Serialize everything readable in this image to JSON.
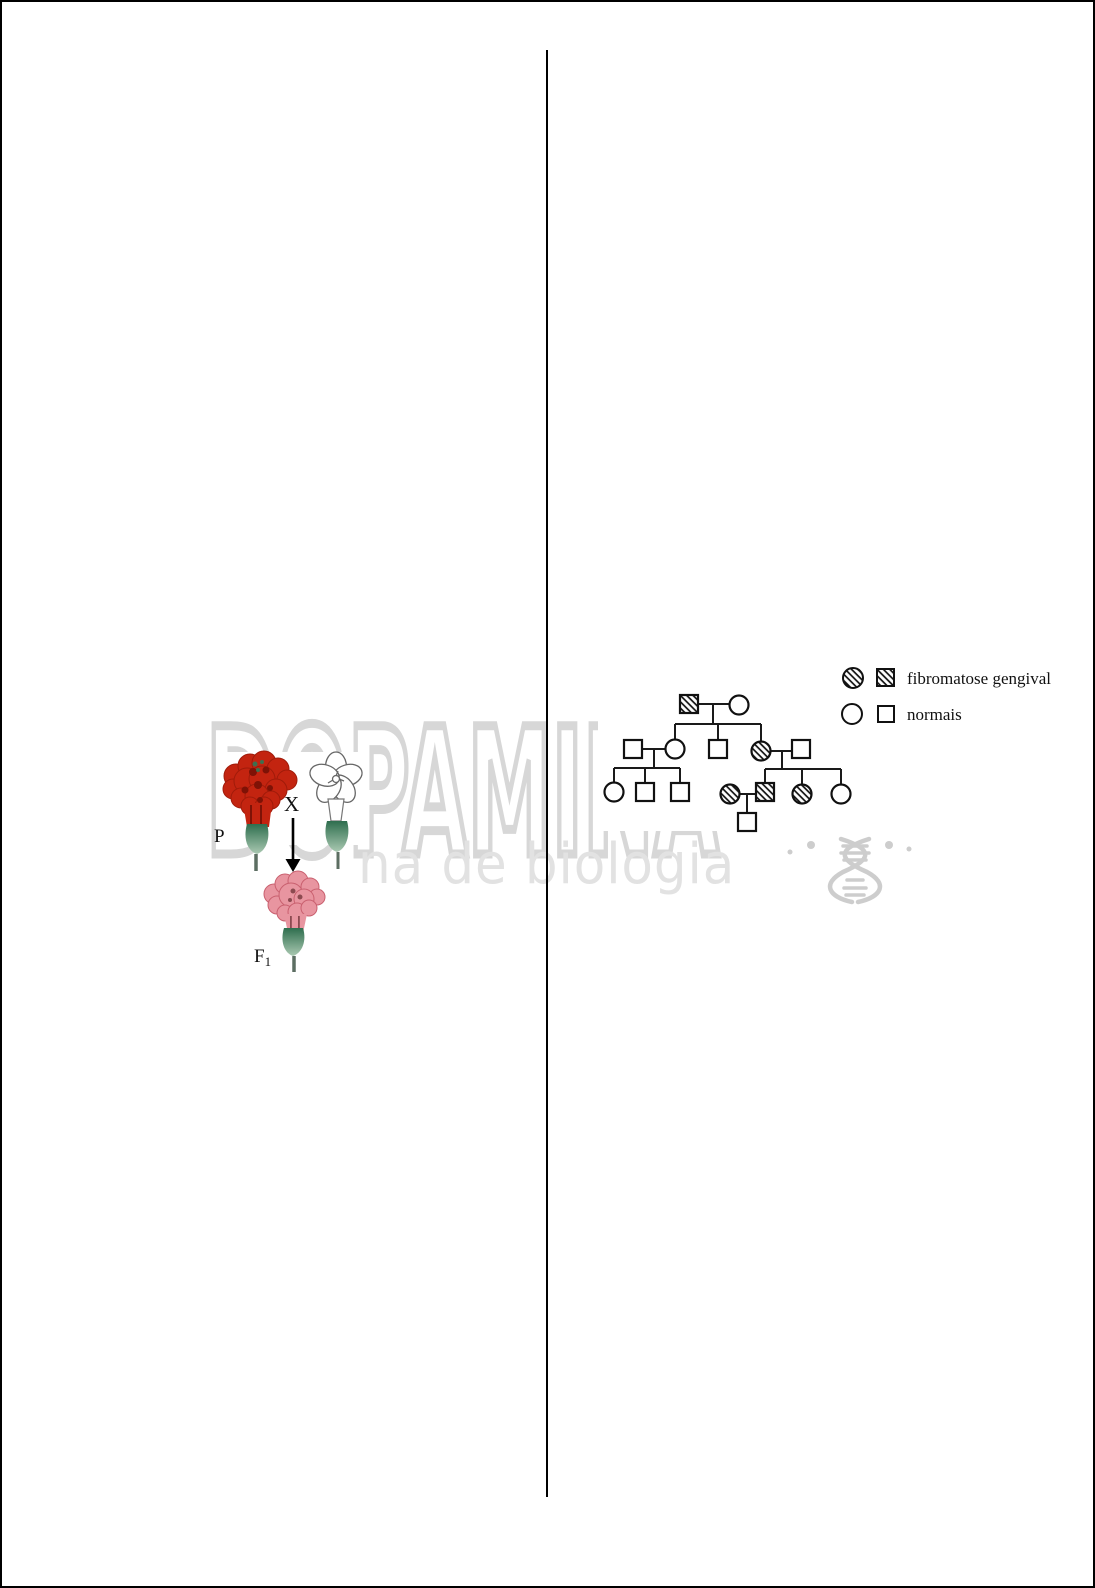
{
  "page": {
    "background": "#ffffff",
    "border_color": "#000000",
    "divider_color": "#000000"
  },
  "watermark": {
    "line1": "DOPAMINA",
    "line2": "na de biologia",
    "line1_color": "#d7d7d7",
    "line2_color": "#e2e2e2",
    "dna_icon_color": "#cdcdcd"
  },
  "flower_cross_figure": {
    "p_label": "P",
    "cross_symbol": "X",
    "f1_label": "F",
    "f1_subscript": "1",
    "colors": {
      "red_flower": "#c32410",
      "red_flower_dark": "#7e1206",
      "green_speck": "#3f6f4f",
      "white_flower_fill": "#ffffff",
      "white_flower_outline": "#666666",
      "pink_flower": "#e895a0",
      "pink_flower_dark": "#c9606f",
      "pink_accent": "#8c4a50",
      "calyx_dark": "#2e6e4e",
      "calyx_light": "#aac9b2",
      "stem": "#5c6e62",
      "arrow": "#000000"
    }
  },
  "pedigree_figure": {
    "condition_name": "fibromatose gengival",
    "legend": [
      {
        "label": "fibromatose gengival",
        "affected": true
      },
      {
        "label": "normais",
        "affected": false
      }
    ],
    "nodes": [
      {
        "id": "I-1",
        "sex": "male",
        "affected": true,
        "x": 99,
        "y": 64
      },
      {
        "id": "I-2",
        "sex": "female",
        "affected": false,
        "x": 149,
        "y": 65
      },
      {
        "id": "II-1",
        "sex": "male",
        "affected": false,
        "x": 43,
        "y": 109
      },
      {
        "id": "II-2",
        "sex": "female",
        "affected": false,
        "x": 85,
        "y": 109
      },
      {
        "id": "II-3",
        "sex": "male",
        "affected": false,
        "x": 128,
        "y": 109
      },
      {
        "id": "II-4",
        "sex": "female",
        "affected": true,
        "x": 171,
        "y": 111
      },
      {
        "id": "II-5",
        "sex": "male",
        "affected": false,
        "x": 211,
        "y": 109
      },
      {
        "id": "III-1",
        "sex": "female",
        "affected": false,
        "x": 24,
        "y": 152
      },
      {
        "id": "III-2",
        "sex": "male",
        "affected": false,
        "x": 55,
        "y": 152
      },
      {
        "id": "III-3",
        "sex": "male",
        "affected": false,
        "x": 90,
        "y": 152
      },
      {
        "id": "III-4",
        "sex": "female",
        "affected": true,
        "x": 140,
        "y": 154
      },
      {
        "id": "III-5",
        "sex": "male",
        "affected": true,
        "x": 175,
        "y": 152
      },
      {
        "id": "III-6",
        "sex": "female",
        "affected": true,
        "x": 212,
        "y": 154
      },
      {
        "id": "III-7",
        "sex": "female",
        "affected": false,
        "x": 251,
        "y": 154
      },
      {
        "id": "IV-1",
        "sex": "male",
        "affected": false,
        "x": 157,
        "y": 182
      }
    ],
    "links": [
      {
        "x1": 108,
        "y1": 64,
        "x2": 140,
        "y2": 64
      },
      {
        "x1": 123,
        "y1": 64,
        "x2": 123,
        "y2": 84
      },
      {
        "x1": 85,
        "y1": 84,
        "x2": 171,
        "y2": 84
      },
      {
        "x1": 85,
        "y1": 84,
        "x2": 85,
        "y2": 100
      },
      {
        "x1": 128,
        "y1": 84,
        "x2": 128,
        "y2": 100
      },
      {
        "x1": 171,
        "y1": 84,
        "x2": 171,
        "y2": 102
      },
      {
        "x1": 52,
        "y1": 109,
        "x2": 76,
        "y2": 109
      },
      {
        "x1": 64,
        "y1": 109,
        "x2": 64,
        "y2": 128
      },
      {
        "x1": 24,
        "y1": 128,
        "x2": 90,
        "y2": 128
      },
      {
        "x1": 24,
        "y1": 128,
        "x2": 24,
        "y2": 143
      },
      {
        "x1": 55,
        "y1": 128,
        "x2": 55,
        "y2": 143
      },
      {
        "x1": 90,
        "y1": 128,
        "x2": 90,
        "y2": 143
      },
      {
        "x1": 181,
        "y1": 111,
        "x2": 202,
        "y2": 111
      },
      {
        "x1": 192,
        "y1": 111,
        "x2": 192,
        "y2": 129
      },
      {
        "x1": 175,
        "y1": 129,
        "x2": 251,
        "y2": 129
      },
      {
        "x1": 175,
        "y1": 129,
        "x2": 175,
        "y2": 143
      },
      {
        "x1": 212,
        "y1": 129,
        "x2": 212,
        "y2": 145
      },
      {
        "x1": 251,
        "y1": 129,
        "x2": 251,
        "y2": 145
      },
      {
        "x1": 150,
        "y1": 154,
        "x2": 166,
        "y2": 154
      },
      {
        "x1": 157,
        "y1": 154,
        "x2": 157,
        "y2": 173
      }
    ]
  }
}
